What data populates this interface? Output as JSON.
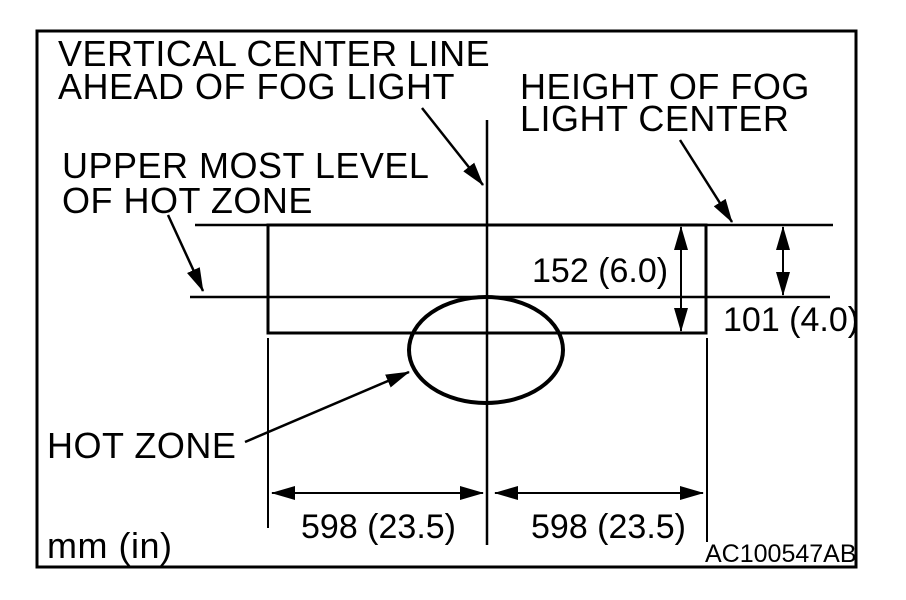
{
  "figure": {
    "labels": {
      "vertical_center_line": {
        "line1": "VERTICAL CENTER LINE",
        "line2": "AHEAD OF FOG LIGHT"
      },
      "height_of_fog_light": {
        "line1": "HEIGHT OF FOG",
        "line2": "LIGHT CENTER"
      },
      "upper_most_level": {
        "line1": "UPPER MOST LEVEL",
        "line2": "OF HOT ZONE"
      },
      "hot_zone": "HOT ZONE",
      "units": "mm (in)",
      "figure_code": "AC100547AB"
    },
    "dimensions": {
      "screen_height": "152 (6.0)",
      "center_to_upper_level": "101 (4.0)",
      "left_half_width": "598 (23.5)",
      "right_half_width": "598 (23.5)"
    },
    "colors": {
      "ink": "#000000",
      "background": "#ffffff"
    }
  }
}
